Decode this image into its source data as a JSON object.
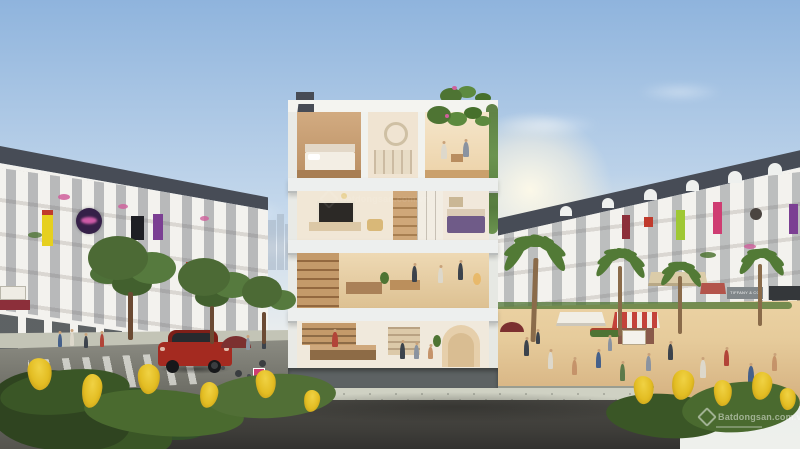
{
  "watermark": {
    "text": "Batdongsan.com.vn",
    "icon": "batdongsan-diamond-logo"
  },
  "signs": {
    "tiffany_label": "TIFFANY & CO"
  },
  "colors": {
    "sky_top": "#8fb4dd",
    "sky_mid": "#c6d9ec",
    "sky_low": "#e9edee",
    "sun_glow": "#fff6e3",
    "skyline": "#a6b4c4",
    "roof_dark": "#474c56",
    "facade": "#f3f2ee",
    "window_glass": "#7c828c",
    "storefront_glass": "#43484c",
    "slab": "#edefee",
    "pier": "#e9eae6",
    "interior_cream": "#f1e7d6",
    "interior_warm": "#e5cfa9",
    "wood": "#c09a6e",
    "wood_dark": "#8d6b46",
    "tv_screen": "#2c2926",
    "bed_purple": "#6f5b88",
    "plant_green": "#4e7433",
    "palm_green": "#527a36",
    "tree_green": "#4c6a35",
    "flower_pink": "#cf5f9b",
    "flower_yellow": "#e9c62f",
    "leaf_dark": "#3c5626",
    "road": "#7e7e76",
    "road_dark": "#4a4944",
    "asphalt_fore": "#3f3e3a",
    "sidewalk": "#cfd1c3",
    "plaza": "#e6cb9b",
    "plaza_dark": "#d4af7e",
    "base_plinth": "#5d6263",
    "car_red": "#a42a20",
    "car_red_dark": "#7e1f18",
    "car_glass": "#272a2e",
    "awning_beige": "#dbcca9",
    "awning_red": "#b3544b",
    "stall_red": "#c4423a",
    "stall_white": "#f1eee5",
    "umbrella_maroon": "#7c3030",
    "sign_yellow": "#e6d01f",
    "sign_red": "#c03a2c",
    "sign_black": "#1e1f24",
    "sign_purple_dark": "#352048",
    "sign_neon_pink": "#e865b8",
    "sign_violet": "#7b3f93",
    "sign_green": "#9fc834",
    "sign_magenta": "#cf3d72",
    "sign_maroon": "#8c2f3a",
    "tiffany_board": "#81878a",
    "dark_board": "#34373a",
    "watermark_white": "rgba(255,255,255,0.6)"
  }
}
